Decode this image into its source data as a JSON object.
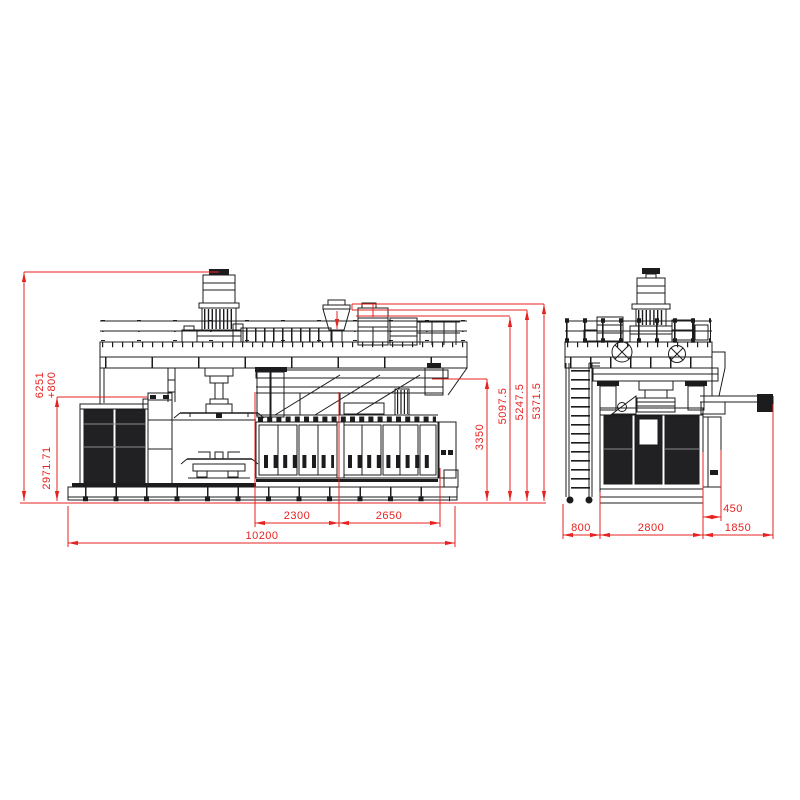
{
  "drawing": {
    "background": "#ffffff",
    "line_color": "#1c1c1e",
    "dimension_color": "#e62320",
    "dimensions": {
      "side_view": {
        "total_height": "6251",
        "height_suffix": "+800",
        "guard_height": "2971.71",
        "clamp_height": "3350",
        "level_low": "5097.5",
        "level_mid": "5247.5",
        "level_top": "5371.5",
        "span_a": "2300",
        "span_b": "2650",
        "total_length": "10200"
      },
      "end_view": {
        "ladder_depth": "800",
        "body_width": "2800",
        "conveyor_span": "1850",
        "conveyor_offset": "450"
      }
    }
  }
}
